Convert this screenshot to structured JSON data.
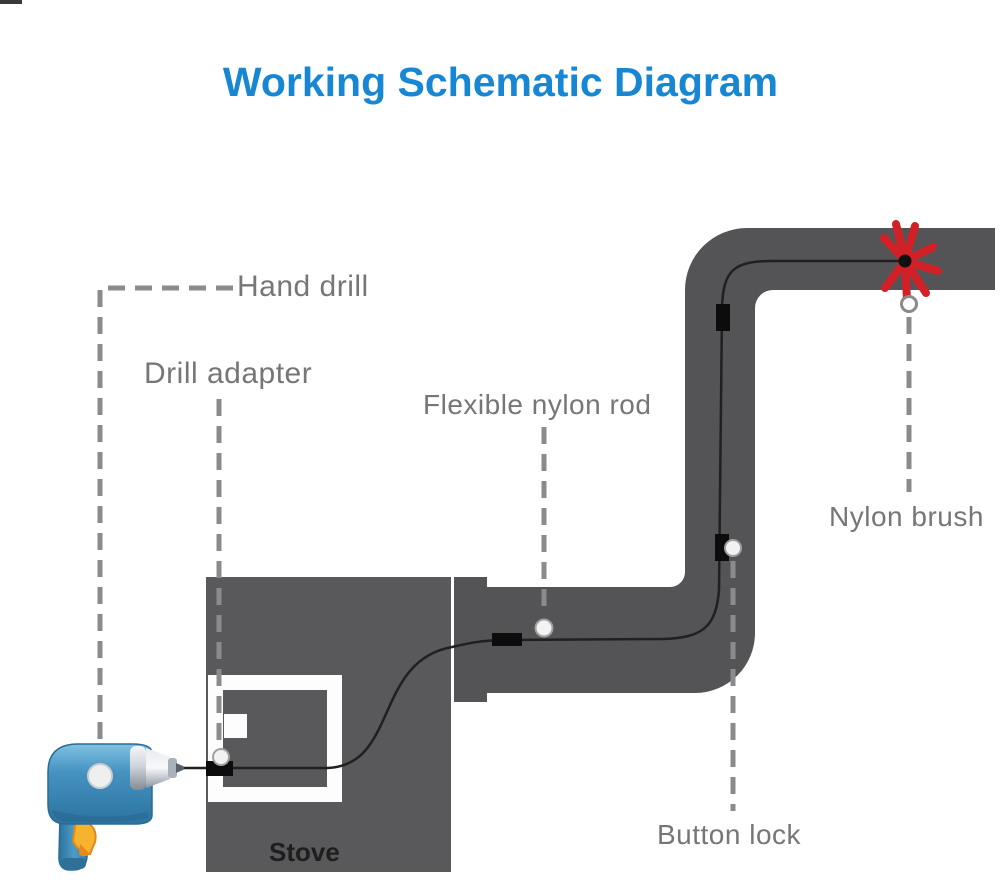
{
  "title": {
    "text": "Working Schematic Diagram",
    "color": "#1787d3"
  },
  "labels": {
    "hand_drill": "Hand drill",
    "drill_adapter": "Drill adapter",
    "flexible_nylon_rod": "Flexible nylon rod",
    "nylon_brush": "Nylon brush",
    "button_lock": "Button lock",
    "stove": "Stove"
  },
  "colors": {
    "title_blue": "#1787d3",
    "duct_gray": "#545456",
    "stove_gray": "#59595b",
    "label_gray": "#757678",
    "leader_dash_gray": "#8b8b8d",
    "rod_black": "#202020",
    "connector_black": "#0c0c0c",
    "brush_red": "#d22027",
    "drill_body_blue": "#3d8abb",
    "drill_trigger_yellow": "#f5b32e",
    "chuck_silver": "#b9c0c8"
  }
}
